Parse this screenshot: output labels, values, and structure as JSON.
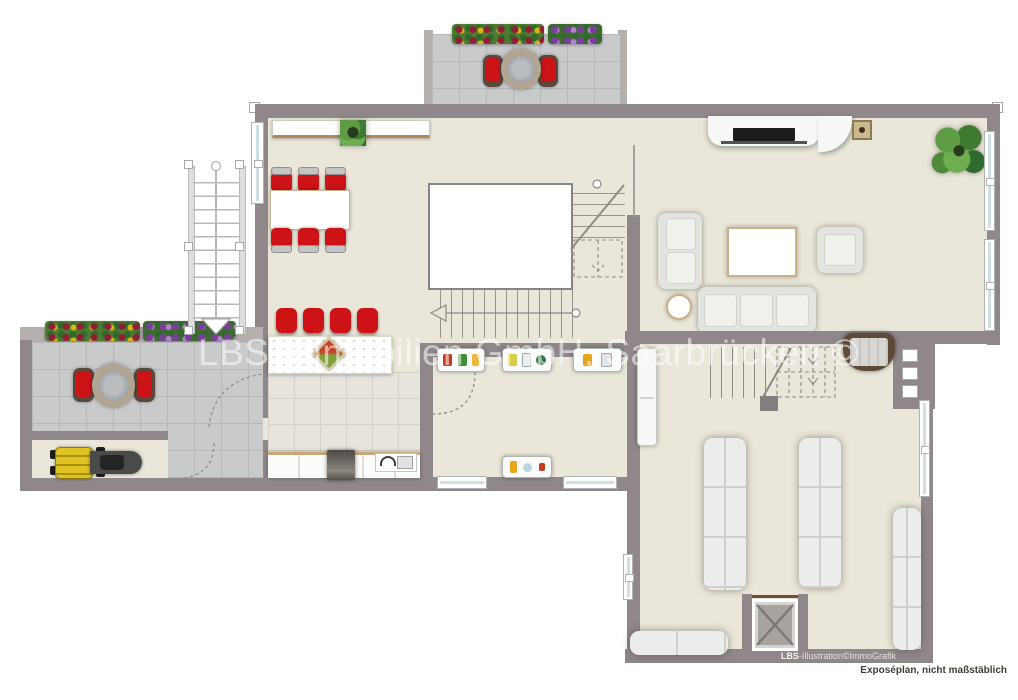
{
  "texts": {
    "watermark": "LBS Immobilien GmbH, Saarbrücken ©",
    "credit_brand": "LBS",
    "credit_rest": "-Illustration©ImmoGrafik",
    "disclaimer": "Exposéplan, nicht maßstäblich"
  },
  "colors": {
    "wall_gray": "#8f8789",
    "floor_beige": "#eae6d9",
    "stone_tile": "#c9cacc",
    "kitchen_tile": "#e7e4de",
    "accent_red": "#ce1317",
    "window_glass": "#cfe0e5",
    "bench_upholstery": "#ececea",
    "plant_green": "#4e8a3a",
    "mower_yellow": "#dfc223",
    "wood_trim": "#b08a5a"
  },
  "furniture_icons": [
    "balcony-bistro-table",
    "balcony-chair",
    "flower-box",
    "glass-door",
    "external-staircase",
    "sideboard",
    "dining-table",
    "dining-chair",
    "potted-plant",
    "bar-counter",
    "bar-stool",
    "kitchen-counter",
    "stove",
    "sink",
    "pantry-food-shelf",
    "door-swing-arc",
    "tv-lowboard",
    "tv",
    "wall-unit",
    "sofa-2seat",
    "sofa-3seat",
    "armchair",
    "coffee-table",
    "side-table",
    "staircase-up",
    "staircase-down",
    "lounger-bench",
    "wardrobe-cabinet",
    "elevator-shaft",
    "terrace-table",
    "terrace-chair",
    "lawn-mower",
    "window"
  ]
}
